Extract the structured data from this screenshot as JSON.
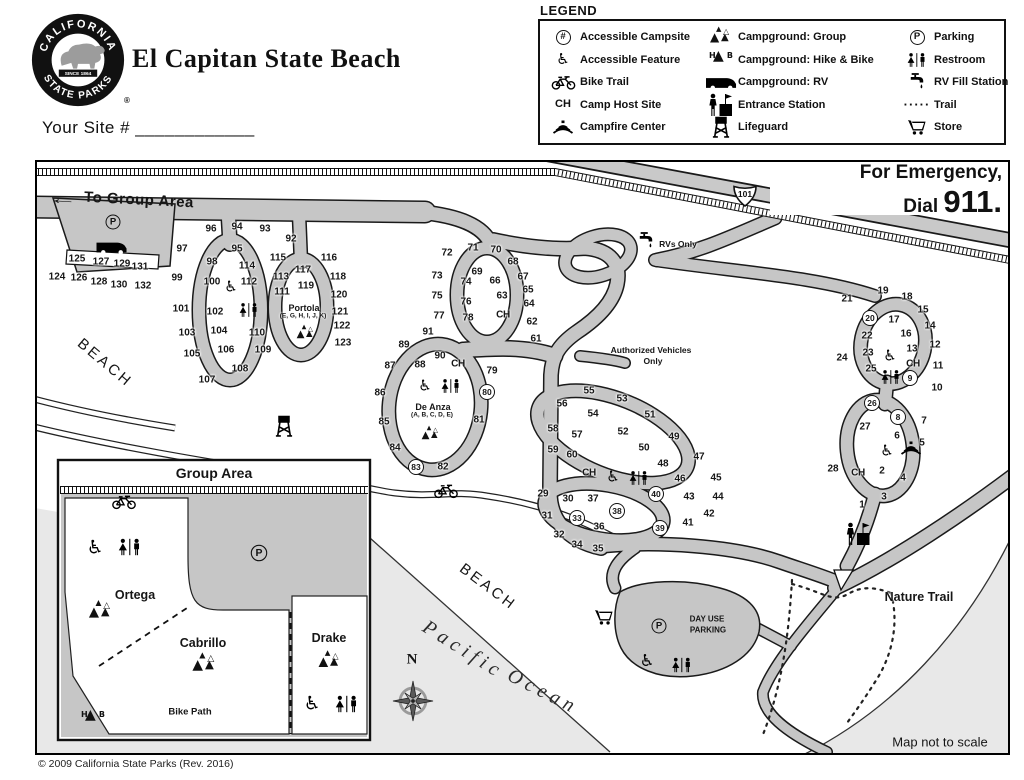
{
  "header": {
    "title": "El Capitan State Beach",
    "site_line": "Your Site # ____________",
    "logo": {
      "top": "CALIFORNIA",
      "bottom": "STATE PARKS",
      "since": "SINCE 1864",
      "reg": "®"
    }
  },
  "legend": {
    "title": "LEGEND",
    "columns": [
      [
        {
          "icon": "hash",
          "label": "Accessible Campsite"
        },
        {
          "icon": "wheelchair",
          "label": "Accessible Feature"
        },
        {
          "icon": "bike",
          "label": "Bike Trail"
        },
        {
          "icon": "ch",
          "label": "Camp Host Site"
        },
        {
          "icon": "campfire",
          "label": "Campfire Center"
        }
      ],
      [
        {
          "icon": "tents",
          "label": "Campground: Group"
        },
        {
          "icon": "hab",
          "label": "Campground: Hike & Bike"
        },
        {
          "icon": "rv",
          "label": "Campground: RV"
        },
        {
          "icon": "entrance",
          "label": "Entrance Station"
        },
        {
          "icon": "lifeguard",
          "label": "Lifeguard"
        }
      ],
      [
        {
          "icon": "pcircle",
          "label": "Parking"
        },
        {
          "icon": "restroom",
          "label": "Restroom"
        },
        {
          "icon": "faucet",
          "label": "RV Fill Station"
        },
        {
          "icon": "trail",
          "label": "Trail"
        },
        {
          "icon": "cart",
          "label": "Store"
        }
      ]
    ]
  },
  "icons": {
    "parking_letter": "P",
    "hash": "#",
    "camp_host": "CH",
    "hab_h": "H",
    "hab_b": "B",
    "highway": "101",
    "trail_dots": "·····"
  },
  "map": {
    "emergency": {
      "line1": "For Emergency,",
      "dial": "Dial ",
      "number": "911."
    },
    "copyright": "© 2009 California State Parks (Rev. 2016)",
    "sites": [
      [
        1,
        827,
        345
      ],
      [
        2,
        847,
        311
      ],
      [
        3,
        849,
        337
      ],
      [
        4,
        868,
        318
      ],
      [
        5,
        887,
        283
      ],
      [
        6,
        862,
        276
      ],
      [
        7,
        889,
        261
      ],
      [
        8,
        863,
        257,
        1
      ],
      [
        9,
        875,
        218,
        1
      ],
      [
        10,
        902,
        228
      ],
      [
        11,
        903,
        206
      ],
      [
        12,
        900,
        185
      ],
      [
        13,
        877,
        189
      ],
      [
        14,
        895,
        166
      ],
      [
        15,
        888,
        150
      ],
      [
        16,
        871,
        174
      ],
      [
        17,
        859,
        160
      ],
      [
        18,
        872,
        137
      ],
      [
        19,
        848,
        131
      ],
      [
        20,
        835,
        158,
        1
      ],
      [
        21,
        812,
        139
      ],
      [
        22,
        832,
        176
      ],
      [
        23,
        833,
        193
      ],
      [
        24,
        807,
        198
      ],
      [
        25,
        836,
        209
      ],
      [
        26,
        837,
        243,
        1
      ],
      [
        27,
        830,
        267
      ],
      [
        28,
        798,
        309
      ],
      [
        29,
        508,
        334
      ],
      [
        30,
        533,
        339
      ],
      [
        31,
        512,
        356
      ],
      [
        32,
        524,
        375
      ],
      [
        33,
        542,
        358,
        1
      ],
      [
        34,
        542,
        385
      ],
      [
        35,
        563,
        389
      ],
      [
        36,
        564,
        367
      ],
      [
        37,
        558,
        339
      ],
      [
        38,
        582,
        351,
        1
      ],
      [
        39,
        625,
        368,
        1
      ],
      [
        40,
        621,
        334,
        1
      ],
      [
        41,
        653,
        363
      ],
      [
        42,
        674,
        354
      ],
      [
        43,
        654,
        337
      ],
      [
        44,
        683,
        337
      ],
      [
        45,
        681,
        318
      ],
      [
        46,
        645,
        319
      ],
      [
        47,
        664,
        297
      ],
      [
        48,
        628,
        304
      ],
      [
        49,
        639,
        277
      ],
      [
        50,
        609,
        288
      ],
      [
        51,
        615,
        255
      ],
      [
        52,
        588,
        272
      ],
      [
        53,
        587,
        239
      ],
      [
        54,
        558,
        254
      ],
      [
        55,
        554,
        231
      ],
      [
        56,
        527,
        244
      ],
      [
        57,
        542,
        275
      ],
      [
        58,
        518,
        269
      ],
      [
        59,
        518,
        290
      ],
      [
        60,
        537,
        295
      ],
      [
        61,
        501,
        179
      ],
      [
        62,
        497,
        162
      ],
      [
        63,
        467,
        136
      ],
      [
        64,
        494,
        144
      ],
      [
        65,
        493,
        130
      ],
      [
        66,
        460,
        121
      ],
      [
        67,
        488,
        117
      ],
      [
        68,
        478,
        102
      ],
      [
        69,
        442,
        112
      ],
      [
        70,
        461,
        90
      ],
      [
        71,
        438,
        88
      ],
      [
        72,
        412,
        93
      ],
      [
        73,
        402,
        116
      ],
      [
        74,
        431,
        122
      ],
      [
        75,
        402,
        136
      ],
      [
        76,
        431,
        142
      ],
      [
        77,
        404,
        156
      ],
      [
        78,
        433,
        158
      ],
      [
        79,
        457,
        211
      ],
      [
        80,
        452,
        232,
        1
      ],
      [
        81,
        444,
        260
      ],
      [
        82,
        408,
        307
      ],
      [
        83,
        381,
        307,
        1
      ],
      [
        84,
        360,
        288
      ],
      [
        85,
        349,
        262
      ],
      [
        86,
        345,
        233
      ],
      [
        87,
        355,
        206
      ],
      [
        88,
        385,
        205
      ],
      [
        89,
        369,
        185
      ],
      [
        90,
        405,
        196
      ],
      [
        91,
        393,
        172
      ],
      [
        92,
        256,
        79
      ],
      [
        93,
        230,
        69
      ],
      [
        94,
        202,
        67
      ],
      [
        95,
        202,
        89
      ],
      [
        96,
        176,
        69
      ],
      [
        97,
        147,
        89
      ],
      [
        98,
        177,
        102
      ],
      [
        99,
        142,
        118
      ],
      [
        100,
        177,
        122
      ],
      [
        101,
        146,
        149
      ],
      [
        102,
        180,
        152
      ],
      [
        103,
        152,
        173
      ],
      [
        104,
        184,
        171
      ],
      [
        105,
        157,
        194
      ],
      [
        106,
        191,
        190
      ],
      [
        107,
        172,
        220
      ],
      [
        108,
        205,
        209
      ],
      [
        109,
        228,
        190
      ],
      [
        110,
        222,
        173
      ],
      [
        111,
        247,
        132
      ],
      [
        112,
        214,
        122
      ],
      [
        113,
        246,
        117
      ],
      [
        114,
        212,
        106
      ],
      [
        115,
        243,
        98
      ],
      [
        116,
        294,
        98
      ],
      [
        117,
        268,
        110
      ],
      [
        118,
        303,
        117
      ],
      [
        119,
        271,
        126
      ],
      [
        120,
        304,
        135
      ],
      [
        121,
        305,
        152
      ],
      [
        122,
        307,
        166
      ],
      [
        123,
        308,
        183
      ],
      [
        124,
        22,
        117
      ],
      [
        125,
        42,
        99
      ],
      [
        126,
        44,
        118
      ],
      [
        127,
        66,
        102
      ],
      [
        128,
        64,
        122
      ],
      [
        129,
        87,
        104
      ],
      [
        130,
        84,
        125
      ],
      [
        131,
        105,
        107
      ],
      [
        132,
        108,
        126
      ]
    ],
    "texts": [
      {
        "t": "←",
        "x": 28,
        "y": 40,
        "cls": "arrow",
        "rot": 3
      },
      {
        "t": "To Group Area",
        "x": 104,
        "y": 40,
        "cls": "roadlbl",
        "rot": 3
      },
      {
        "t": "RVs Only",
        "x": 643,
        "y": 84,
        "cls": "tiny"
      },
      {
        "t": "Authorized Vehicles",
        "x": 616,
        "y": 190,
        "cls": "tiny"
      },
      {
        "t": "Only",
        "x": 618,
        "y": 201,
        "cls": "tiny"
      },
      {
        "t": "BEACH",
        "x": 70,
        "y": 203,
        "cls": "beach",
        "rot": 40
      },
      {
        "t": "BEACH",
        "x": 453,
        "y": 427,
        "cls": "beach",
        "rot": 37
      },
      {
        "t": "Pacific",
        "x": 428,
        "y": 490,
        "cls": "ocean",
        "rot": 32
      },
      {
        "t": "Ocean",
        "x": 508,
        "y": 532,
        "cls": "ocean",
        "rot": 27
      },
      {
        "t": "Nature Trail",
        "x": 884,
        "y": 437,
        "cls": "mid"
      },
      {
        "t": "Map not to scale",
        "x": 905,
        "y": 582,
        "cls": "mid2"
      },
      {
        "t": "DAY USE",
        "x": 672,
        "y": 459,
        "cls": "tinyb"
      },
      {
        "t": "PARKING",
        "x": 673,
        "y": 470,
        "cls": "tinyb"
      },
      {
        "t": "Portola",
        "x": 269,
        "y": 148,
        "cls": "campname"
      },
      {
        "t": "(E, G, H, I, J, K)",
        "x": 268,
        "y": 156,
        "cls": "campsub"
      },
      {
        "t": "De Anza",
        "x": 398,
        "y": 247,
        "cls": "campname"
      },
      {
        "t": "(A, B, C, D, E)",
        "x": 397,
        "y": 255,
        "cls": "campsub"
      },
      {
        "t": "CH",
        "x": 468,
        "y": 155,
        "cls": "ch"
      },
      {
        "t": "CH",
        "x": 423,
        "y": 204,
        "cls": "ch"
      },
      {
        "t": "CH",
        "x": 554,
        "y": 313,
        "cls": "ch"
      },
      {
        "t": "CH",
        "x": 878,
        "y": 204,
        "cls": "ch"
      },
      {
        "t": "CH",
        "x": 823,
        "y": 313,
        "cls": "ch"
      },
      {
        "t": "N",
        "x": 377,
        "y": 500,
        "cls": "north"
      },
      {
        "t": "Group Area",
        "x": 179,
        "y": 313,
        "cls": "insettitle"
      },
      {
        "t": "Ortega",
        "x": 100,
        "y": 435,
        "cls": "groupname"
      },
      {
        "t": "Cabrillo",
        "x": 168,
        "y": 483,
        "cls": "groupname"
      },
      {
        "t": "Drake",
        "x": 294,
        "y": 478,
        "cls": "groupname"
      },
      {
        "t": "Bike Path",
        "x": 155,
        "y": 552,
        "cls": "bikepath"
      }
    ],
    "markers": [
      {
        "t": "pcircle",
        "x": 78,
        "y": 62
      },
      {
        "t": "rv",
        "x": 77,
        "y": 87
      },
      {
        "t": "wheelchair",
        "x": 196,
        "y": 127
      },
      {
        "t": "restroom",
        "x": 214,
        "y": 150
      },
      {
        "t": "tents",
        "x": 271,
        "y": 174,
        "s": 0.85
      },
      {
        "t": "wheelchair",
        "x": 390,
        "y": 226
      },
      {
        "t": "restroom",
        "x": 416,
        "y": 226
      },
      {
        "t": "tents",
        "x": 396,
        "y": 275,
        "s": 0.85
      },
      {
        "t": "faucet",
        "x": 611,
        "y": 81
      },
      {
        "t": "lifeguard",
        "x": 249,
        "y": 266
      },
      {
        "t": "bike",
        "x": 411,
        "y": 331
      },
      {
        "t": "wheelchair",
        "x": 578,
        "y": 317
      },
      {
        "t": "restroom",
        "x": 604,
        "y": 318
      },
      {
        "t": "wheelchair",
        "x": 855,
        "y": 196
      },
      {
        "t": "restroom",
        "x": 856,
        "y": 217
      },
      {
        "t": "wheelchair",
        "x": 852,
        "y": 291
      },
      {
        "t": "campfire",
        "x": 876,
        "y": 288
      },
      {
        "t": "entrance",
        "x": 824,
        "y": 374
      },
      {
        "t": "cart",
        "x": 569,
        "y": 457
      },
      {
        "t": "pcircle",
        "x": 624,
        "y": 466
      },
      {
        "t": "wheelchair",
        "x": 612,
        "y": 501,
        "s": 1.1
      },
      {
        "t": "restroom",
        "x": 647,
        "y": 505,
        "s": 1.05
      },
      {
        "t": "compass",
        "x": 378,
        "y": 541
      },
      {
        "t": "bike",
        "x": 89,
        "y": 342
      },
      {
        "t": "wheelchair",
        "x": 60,
        "y": 388,
        "s": 1.25
      },
      {
        "t": "restroom",
        "x": 95,
        "y": 387,
        "s": 1.2
      },
      {
        "t": "pcircle",
        "x": 224,
        "y": 393,
        "s": 1.1
      },
      {
        "t": "tents",
        "x": 66,
        "y": 452,
        "s": 1.1
      },
      {
        "t": "tents",
        "x": 170,
        "y": 505,
        "s": 1.15
      },
      {
        "t": "tents",
        "x": 295,
        "y": 502,
        "s": 1.05
      },
      {
        "t": "wheelchair",
        "x": 277,
        "y": 544,
        "s": 1.25
      },
      {
        "t": "restroom",
        "x": 312,
        "y": 544,
        "s": 1.2
      },
      {
        "t": "hab",
        "x": 58,
        "y": 559
      },
      {
        "t": "shield",
        "x": 710,
        "y": 36
      }
    ]
  }
}
